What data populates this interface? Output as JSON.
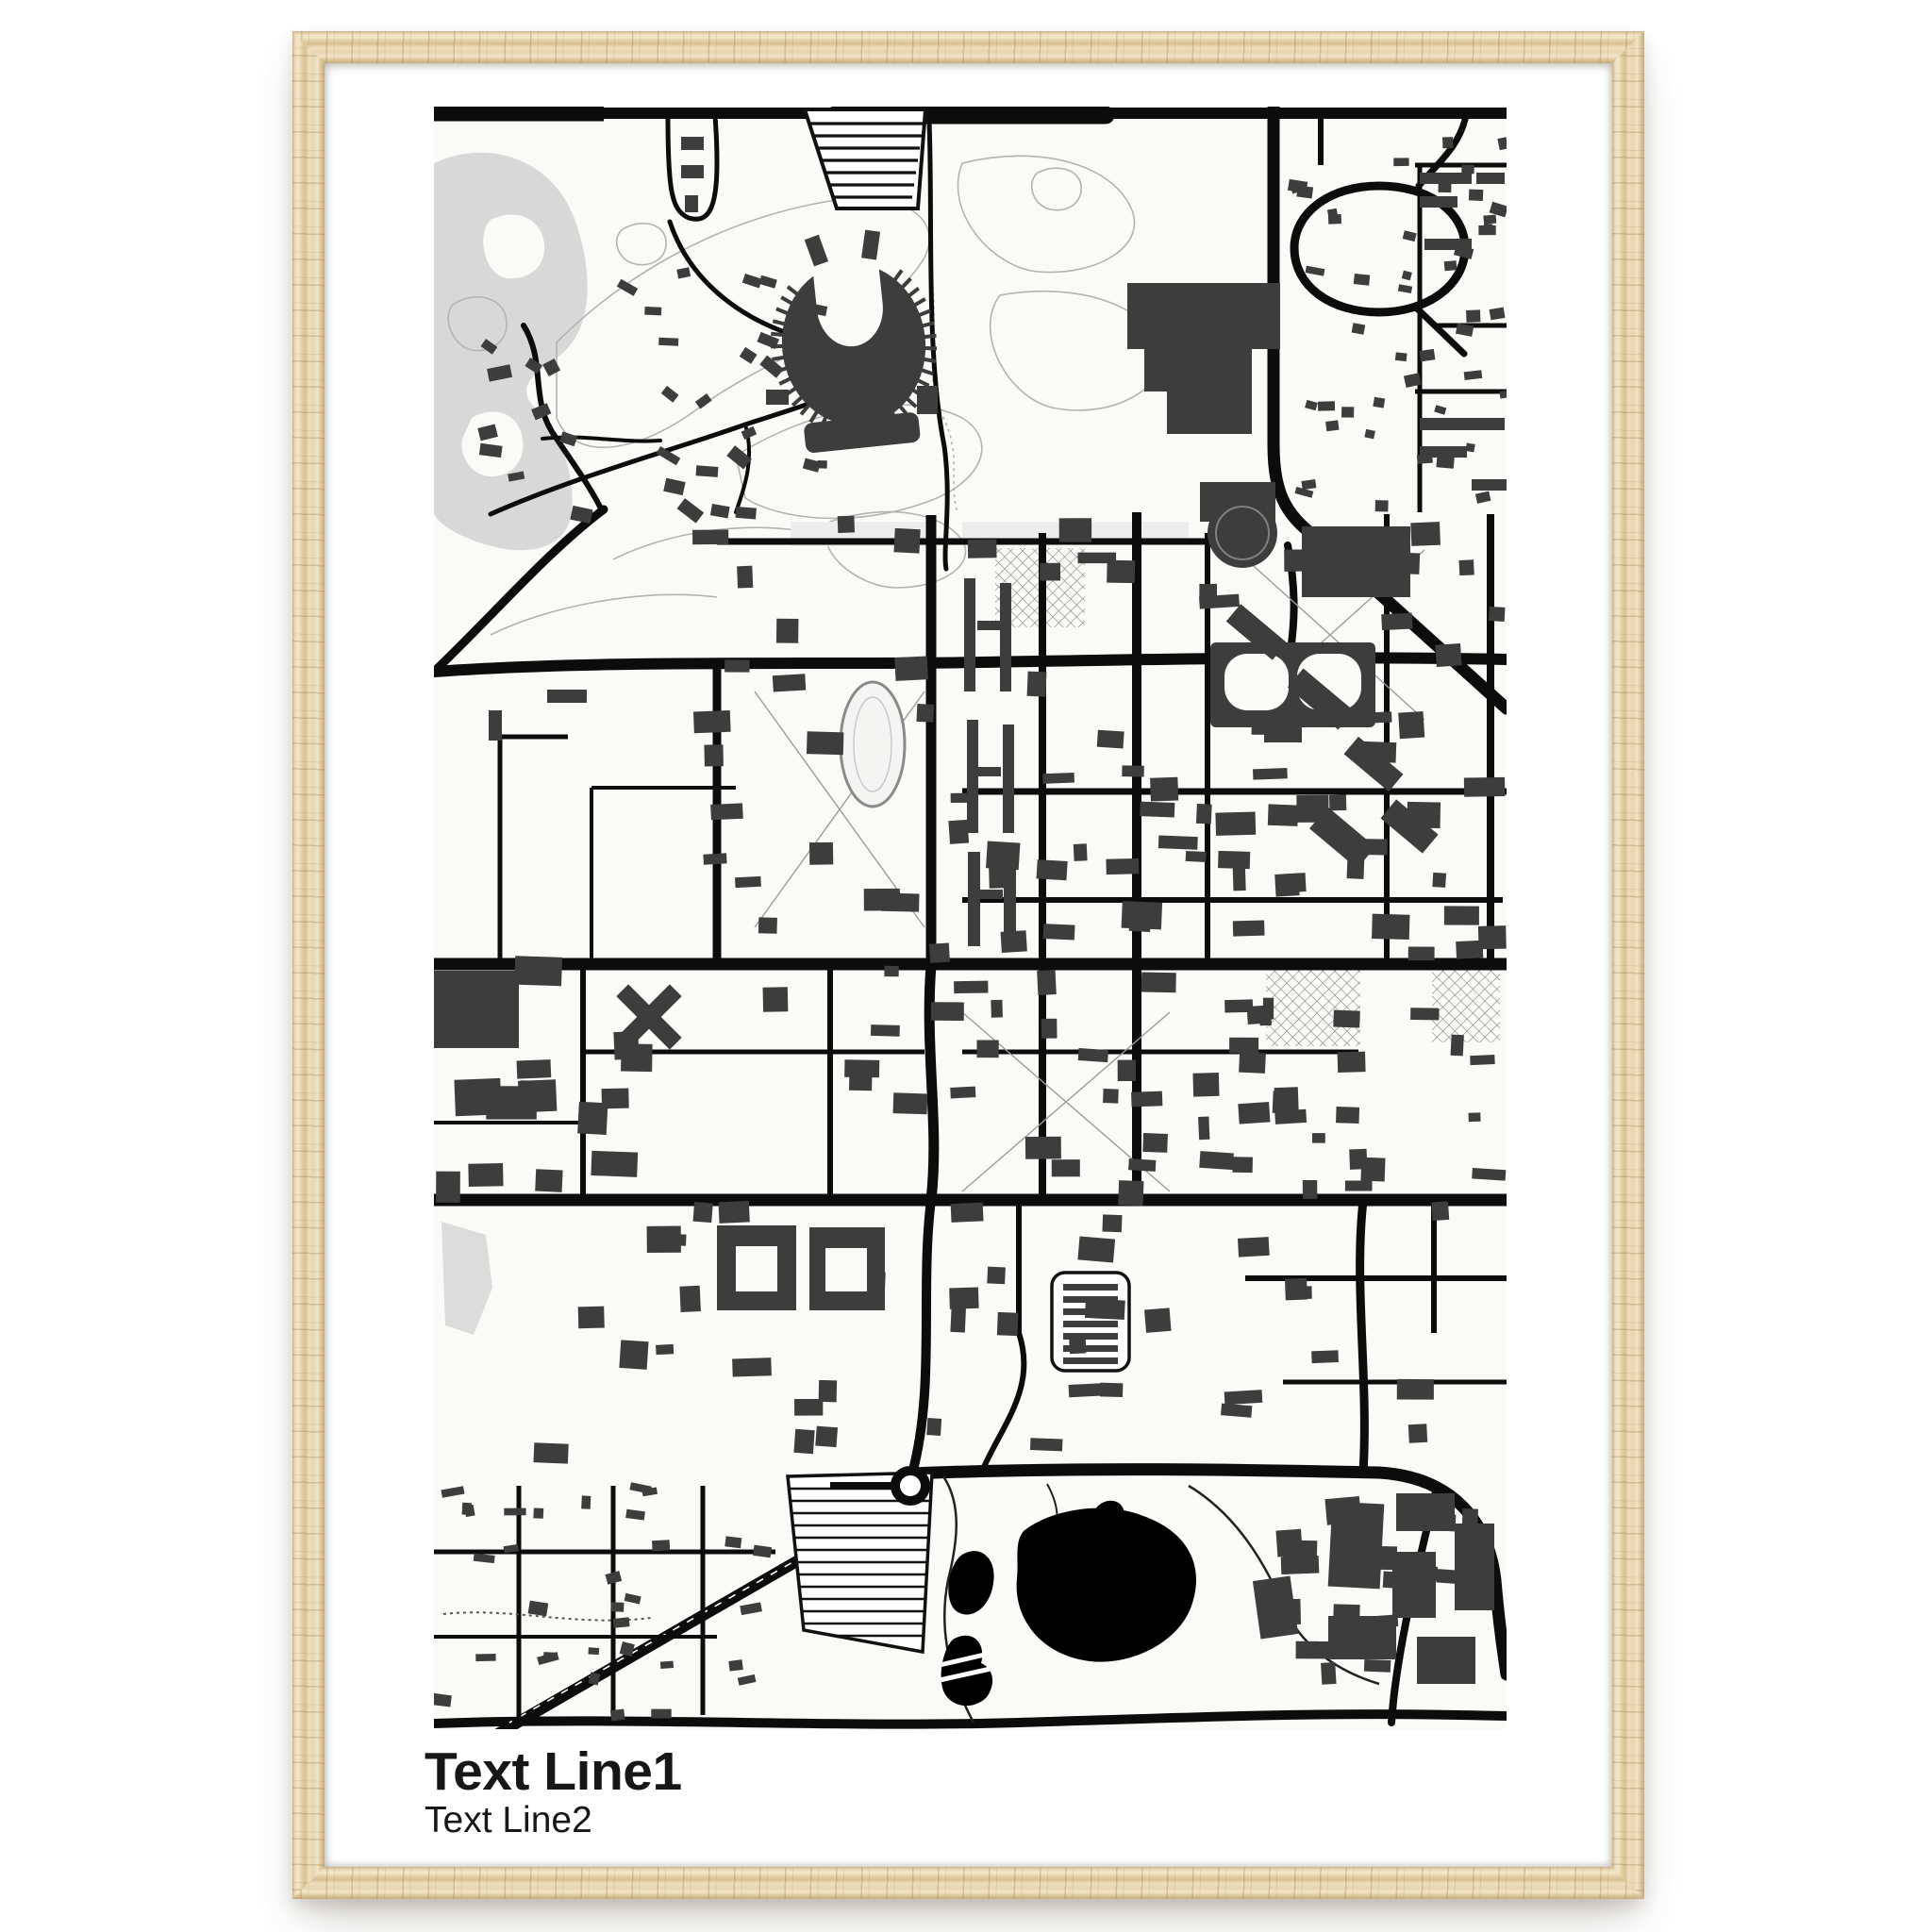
{
  "poster": {
    "title_line1": "Text Line1",
    "title_line2": "Text Line2"
  },
  "frame": {
    "material": "natural-wood",
    "mat": "white"
  },
  "map": {
    "style": "black-and-white street map poster",
    "landmarks": [
      "golf-course-contours",
      "horseshoe-stadium",
      "circular-arena",
      "parking-rows",
      "running-track",
      "residence-hall-slabs",
      "campus-street-grid",
      "roundabout",
      "striped-parking-lot",
      "black-lake-with-islands",
      "residential-neighborhoods"
    ]
  },
  "css_vars": {
    "--page-bg": "#ffffff",
    "--mat": "#ffffff",
    "--map-bg": "#fafaf7",
    "--road": "#0c0c0c",
    "--building": "#3d3d3d",
    "--water": "#000000",
    "--park": "#d8d8d8",
    "--contour": "#b3b3b3",
    "--wood": "#e8d6b3",
    "--wood-grain": "#b4935f"
  }
}
